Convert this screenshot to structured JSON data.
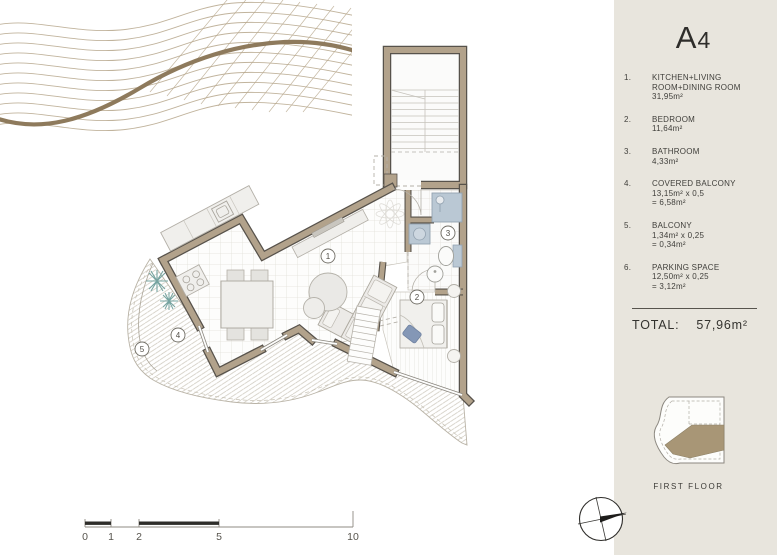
{
  "panel": {
    "title": {
      "letter": "A",
      "digit": "4"
    },
    "legend": [
      {
        "num": "1.",
        "lines": [
          "KITCHEN+LIVING",
          "ROOM+DINING ROOM",
          "31,95m²"
        ]
      },
      {
        "num": "2.",
        "lines": [
          "BEDROOM",
          "11,64m²"
        ]
      },
      {
        "num": "3.",
        "lines": [
          "BATHROOM",
          "4,33m²"
        ]
      },
      {
        "num": "4.",
        "lines": [
          "COVERED BALCONY",
          "13,15m² x 0,5",
          "= 6,58m²"
        ]
      },
      {
        "num": "5.",
        "lines": [
          "BALCONY",
          "1,34m² x 0,25",
          "= 0,34m²"
        ]
      },
      {
        "num": "6.",
        "lines": [
          "PARKING SPACE",
          "12,50m² x 0,25",
          "= 3,12m²"
        ]
      }
    ],
    "total": {
      "label": "TOTAL:",
      "value": "57,96m²"
    },
    "keyplan_caption": "FIRST FLOOR"
  },
  "plan": {
    "room_labels": [
      "1",
      "2",
      "3",
      "4",
      "5"
    ],
    "scale_ticks": [
      "0",
      "1",
      "2",
      "5",
      "10"
    ]
  },
  "colors": {
    "panel_bg": "#e8e5dd",
    "wall_tan": "#b2a28b",
    "wall_edge": "#57524b",
    "fixture_blue": "#bac8d4",
    "plant_teal": "#76a4a1",
    "keyplan_brown": "#a89676",
    "contour_brown": "#8e7a5c",
    "text": "#3b3a36"
  }
}
